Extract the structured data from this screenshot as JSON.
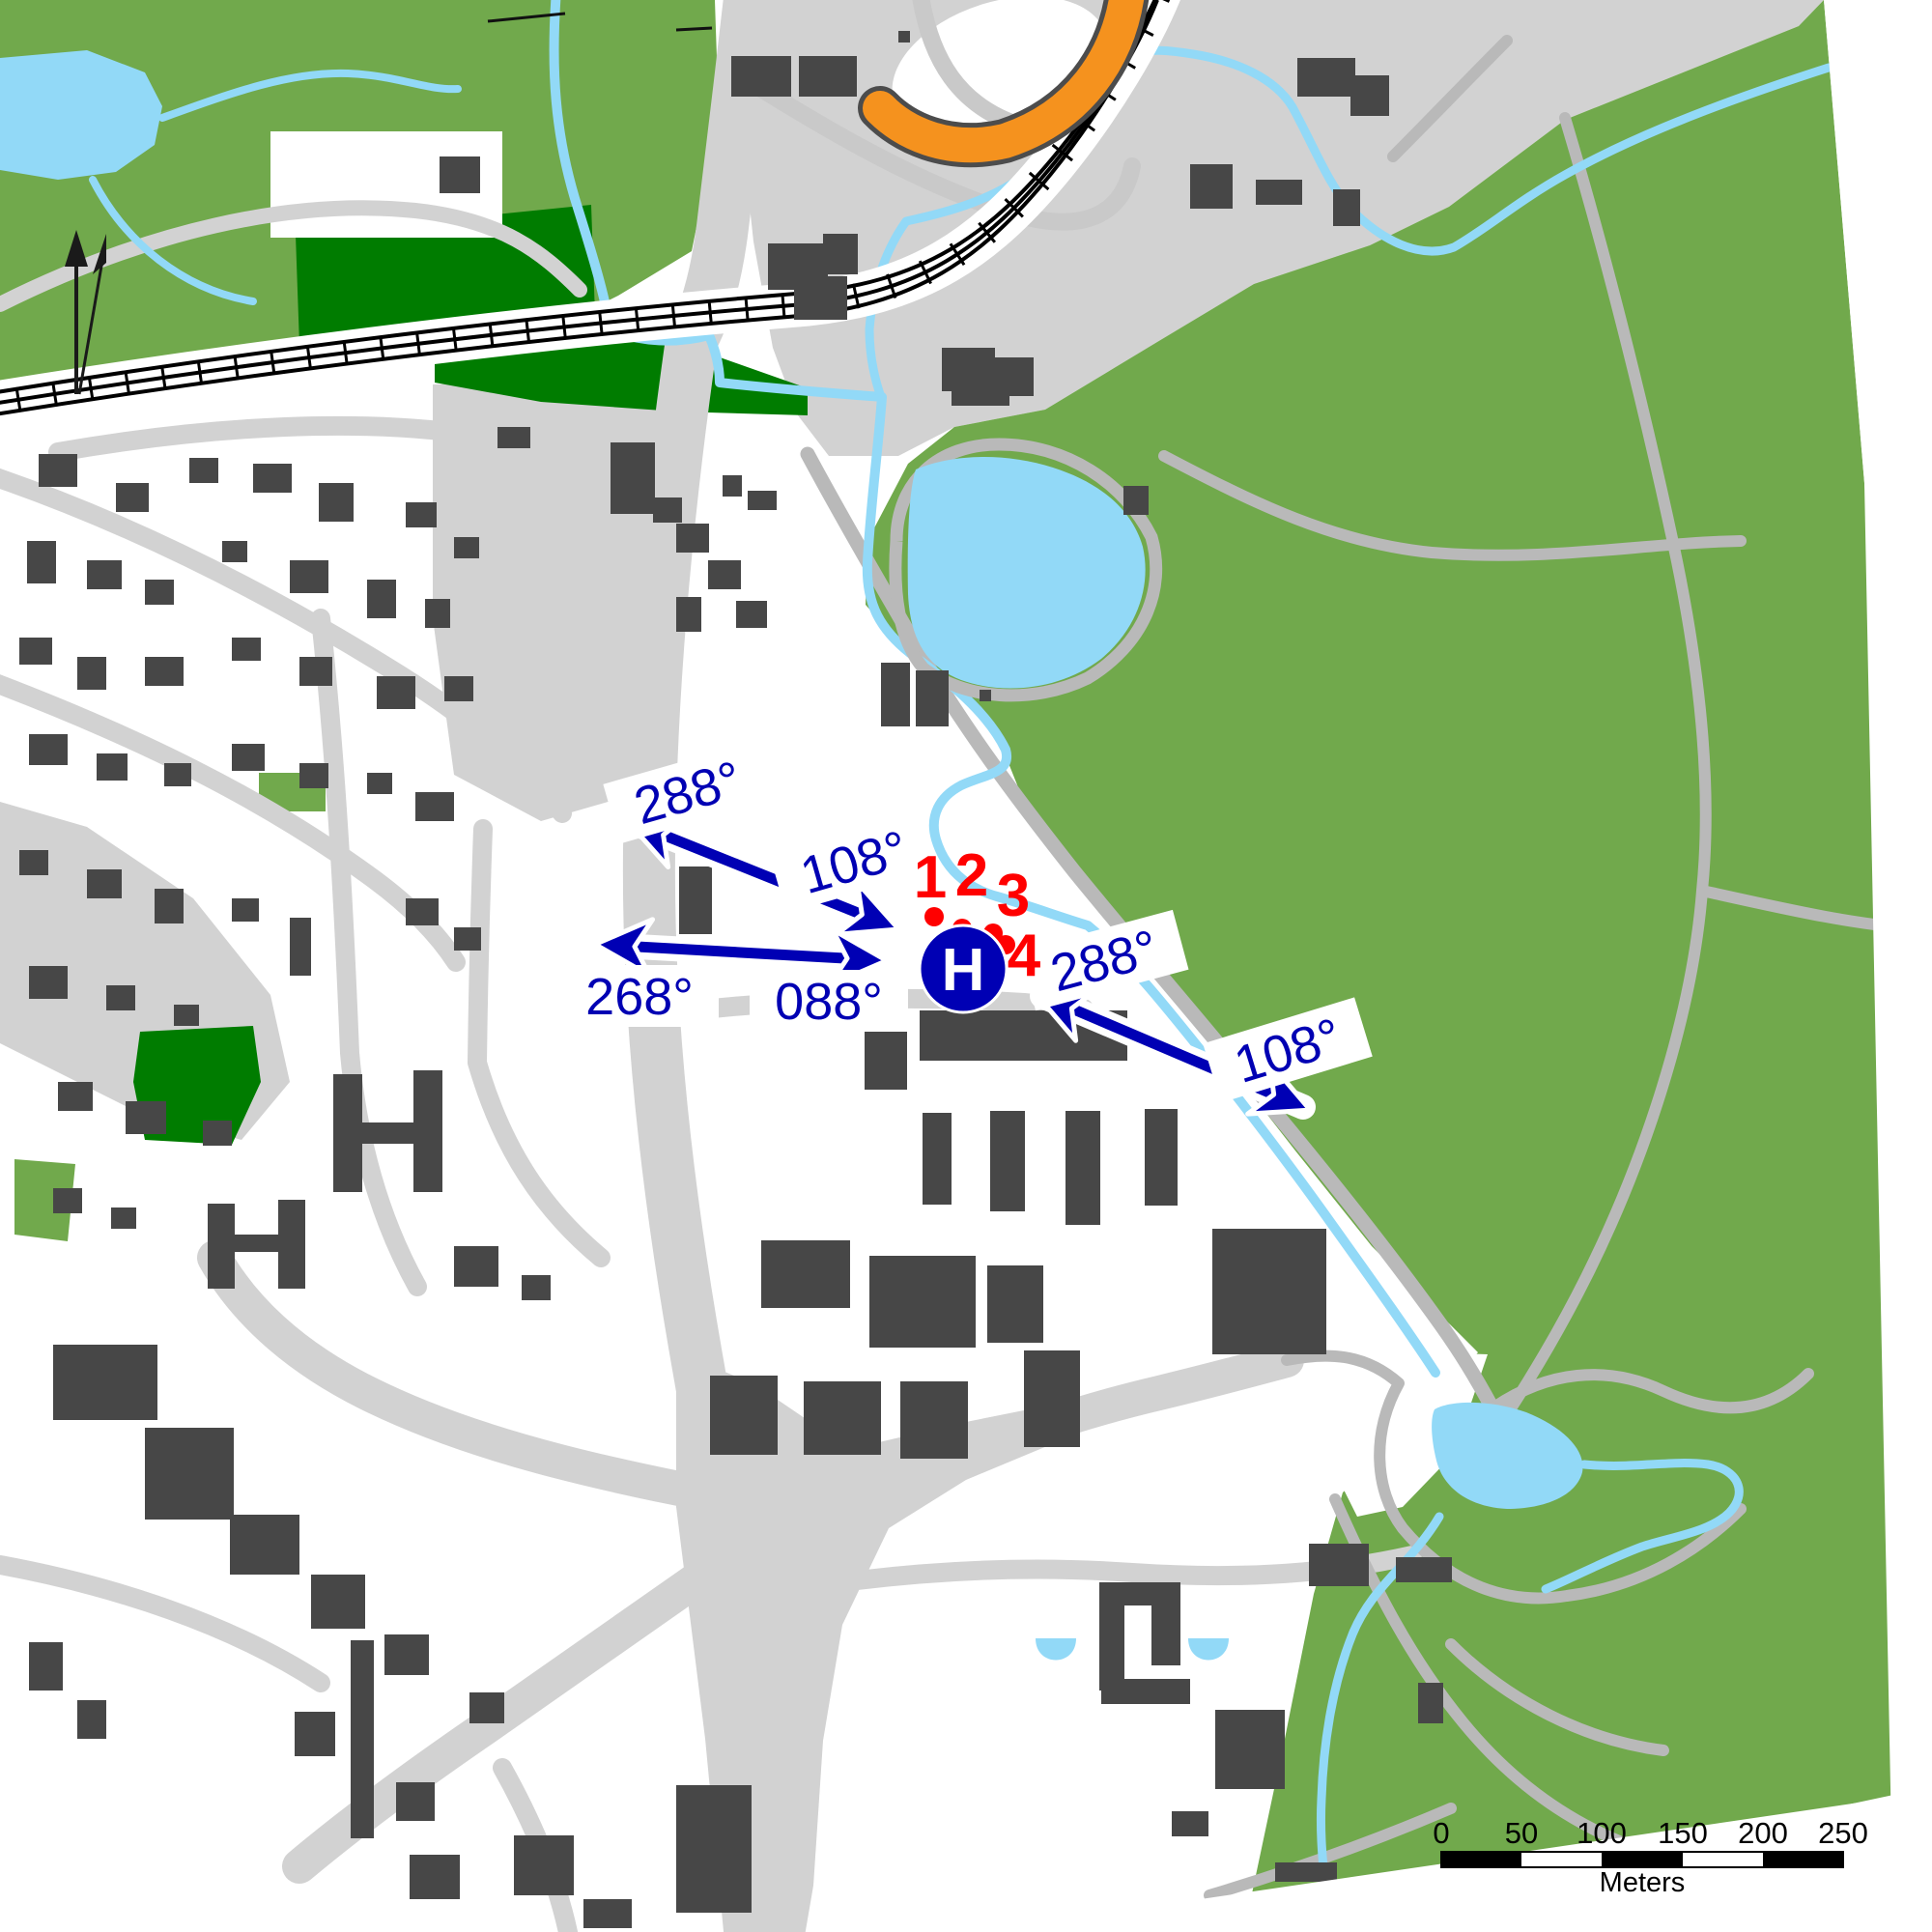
{
  "map": {
    "type": "topographic-site-map",
    "colors": {
      "background": "#ffffff",
      "vegetation_light_green": "#71a94c",
      "vegetation_dark_green": "#007c00",
      "water_blue": "#92d9f7",
      "road_gray": "#d2d2d2",
      "path_gray": "#b9b9b9",
      "building_gray": "#474747",
      "railway_black": "#000000",
      "highway_orange": "#f5921e",
      "annotation_blue": "#0000b4",
      "marker_red": "#ff0000"
    },
    "bearing_labels": [
      {
        "text": "288°",
        "transform": "translate(712,820) rotate(-16)"
      },
      {
        "text": "108°",
        "transform": "translate(884,892) rotate(-16)"
      },
      {
        "text": "268°",
        "transform": "translate(662,1031)"
      },
      {
        "text": "088°",
        "transform": "translate(858,1036)"
      },
      {
        "text": "288°",
        "transform": "translate(1143,994) rotate(-15)"
      },
      {
        "text": "108°",
        "transform": "translate(1333,1087) rotate(-17)"
      }
    ],
    "survey_points": [
      {
        "label": "1",
        "dot_transform": "translate(967,949)",
        "label_transform": "translate(963,908)"
      },
      {
        "label": "2",
        "dot_transform": "translate(996,961)",
        "label_transform": "translate(1006,906)"
      },
      {
        "label": "3",
        "dot_transform": "translate(1028,966)",
        "label_transform": "translate(1049,927)"
      },
      {
        "label": "4",
        "dot_transform": "translate(1041,978)",
        "label_transform": "translate(1060,989)"
      }
    ],
    "helipad": {
      "symbol": "H",
      "transform": "translate(997,1003)"
    },
    "scale_bar": {
      "tick_labels": [
        "0",
        "50",
        "100",
        "150",
        "200",
        "250"
      ],
      "unit_label": "Meters"
    }
  }
}
